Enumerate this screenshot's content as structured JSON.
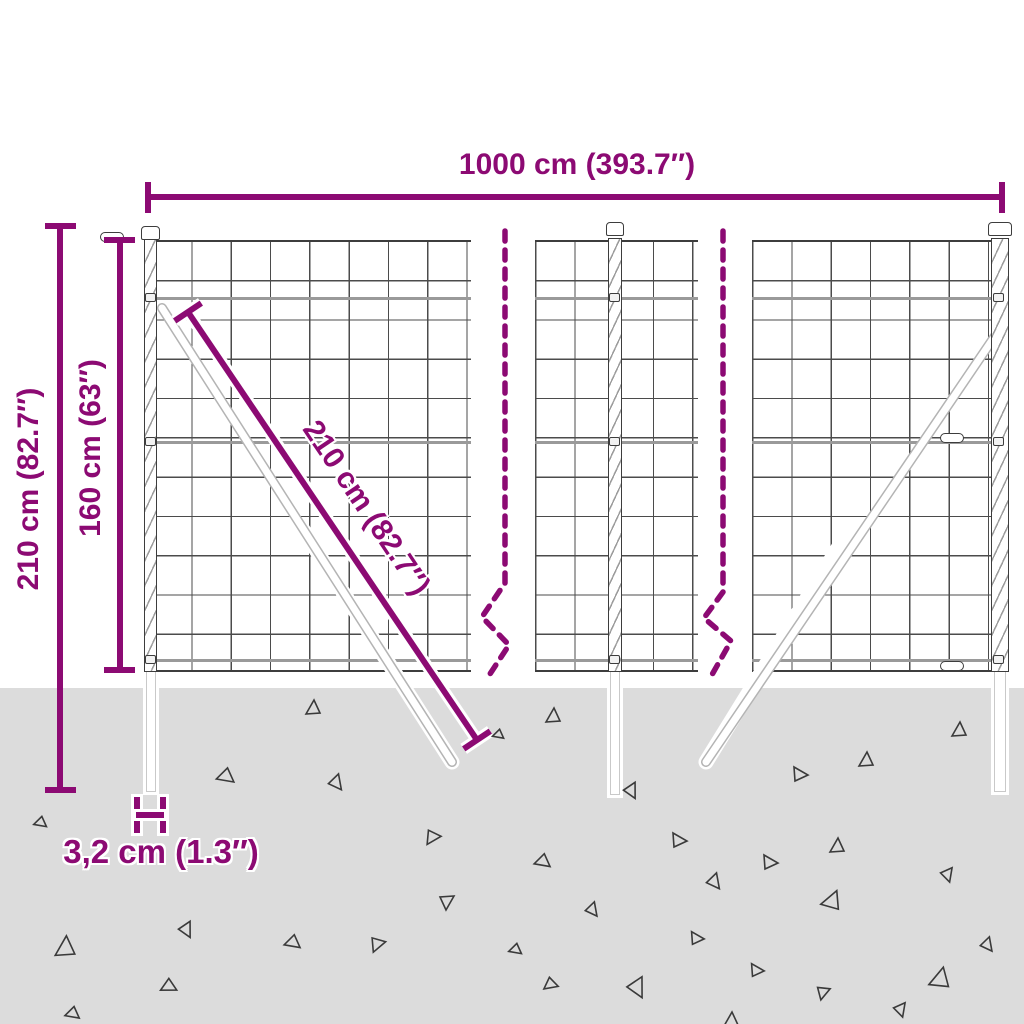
{
  "diagram": {
    "type": "product-dimension-diagram",
    "subject": "wire-mesh-fence-with-posts",
    "labels": {
      "width": "1000 cm (393.7″)",
      "total_height": "210 cm (82.7″)",
      "mesh_height": "160 cm (63″)",
      "diagonal": "210 cm (82.7″)",
      "post_width": "3,2 cm (1.3″)"
    },
    "colors": {
      "accent": "#8C0A73",
      "ground": "#DCDCDC",
      "wire": "#4B4B4B",
      "post_outline": "#3D3D3D",
      "triangle": "#3A3A3A",
      "brace": "#B4B4B4"
    }
  },
  "ground": {
    "triangles": [
      {
        "x": 313,
        "y": 708,
        "r": 0,
        "s": 1
      },
      {
        "x": 553,
        "y": 716,
        "r": 0,
        "s": 1
      },
      {
        "x": 959,
        "y": 730,
        "r": 0,
        "s": 1
      },
      {
        "x": 866,
        "y": 760,
        "r": 0,
        "s": 1
      },
      {
        "x": 800,
        "y": 774,
        "r": 90,
        "s": 1
      },
      {
        "x": 225,
        "y": 777,
        "r": 250,
        "s": 1.1
      },
      {
        "x": 337,
        "y": 783,
        "r": 140,
        "s": 1
      },
      {
        "x": 632,
        "y": 791,
        "r": 150,
        "s": 1
      },
      {
        "x": 498,
        "y": 735,
        "r": 250,
        "s": 0.7
      },
      {
        "x": 40,
        "y": 823,
        "r": 250,
        "s": 0.8
      },
      {
        "x": 432,
        "y": 838,
        "r": 210,
        "s": 1
      },
      {
        "x": 679,
        "y": 840,
        "r": 90,
        "s": 1
      },
      {
        "x": 837,
        "y": 846,
        "r": 0,
        "s": 1
      },
      {
        "x": 542,
        "y": 862,
        "r": 250,
        "s": 1
      },
      {
        "x": 770,
        "y": 862,
        "r": 90,
        "s": 1
      },
      {
        "x": 948,
        "y": 875,
        "r": 160,
        "s": 0.9
      },
      {
        "x": 715,
        "y": 882,
        "r": 140,
        "s": 1
      },
      {
        "x": 593,
        "y": 910,
        "r": 140,
        "s": 0.9
      },
      {
        "x": 832,
        "y": 900,
        "r": 20,
        "s": 1.3
      },
      {
        "x": 447,
        "y": 902,
        "r": 180,
        "s": 1
      },
      {
        "x": 187,
        "y": 930,
        "r": 150,
        "s": 1
      },
      {
        "x": 65,
        "y": 947,
        "r": 0,
        "s": 1.4
      },
      {
        "x": 292,
        "y": 943,
        "r": 250,
        "s": 1
      },
      {
        "x": 377,
        "y": 945,
        "r": 200,
        "s": 1
      },
      {
        "x": 988,
        "y": 945,
        "r": 140,
        "s": 0.9
      },
      {
        "x": 697,
        "y": 938,
        "r": 90,
        "s": 0.9
      },
      {
        "x": 515,
        "y": 950,
        "r": 250,
        "s": 0.8
      },
      {
        "x": 940,
        "y": 978,
        "r": 10,
        "s": 1.4
      },
      {
        "x": 757,
        "y": 970,
        "r": 90,
        "s": 0.9
      },
      {
        "x": 168,
        "y": 987,
        "r": 240,
        "s": 1
      },
      {
        "x": 550,
        "y": 985,
        "r": 230,
        "s": 0.9
      },
      {
        "x": 638,
        "y": 988,
        "r": 150,
        "s": 1.3
      },
      {
        "x": 823,
        "y": 993,
        "r": 190,
        "s": 0.9
      },
      {
        "x": 901,
        "y": 1010,
        "r": 160,
        "s": 0.9
      },
      {
        "x": 72,
        "y": 1014,
        "r": 250,
        "s": 0.9
      },
      {
        "x": 731,
        "y": 1020,
        "r": 0,
        "s": 1
      }
    ]
  }
}
